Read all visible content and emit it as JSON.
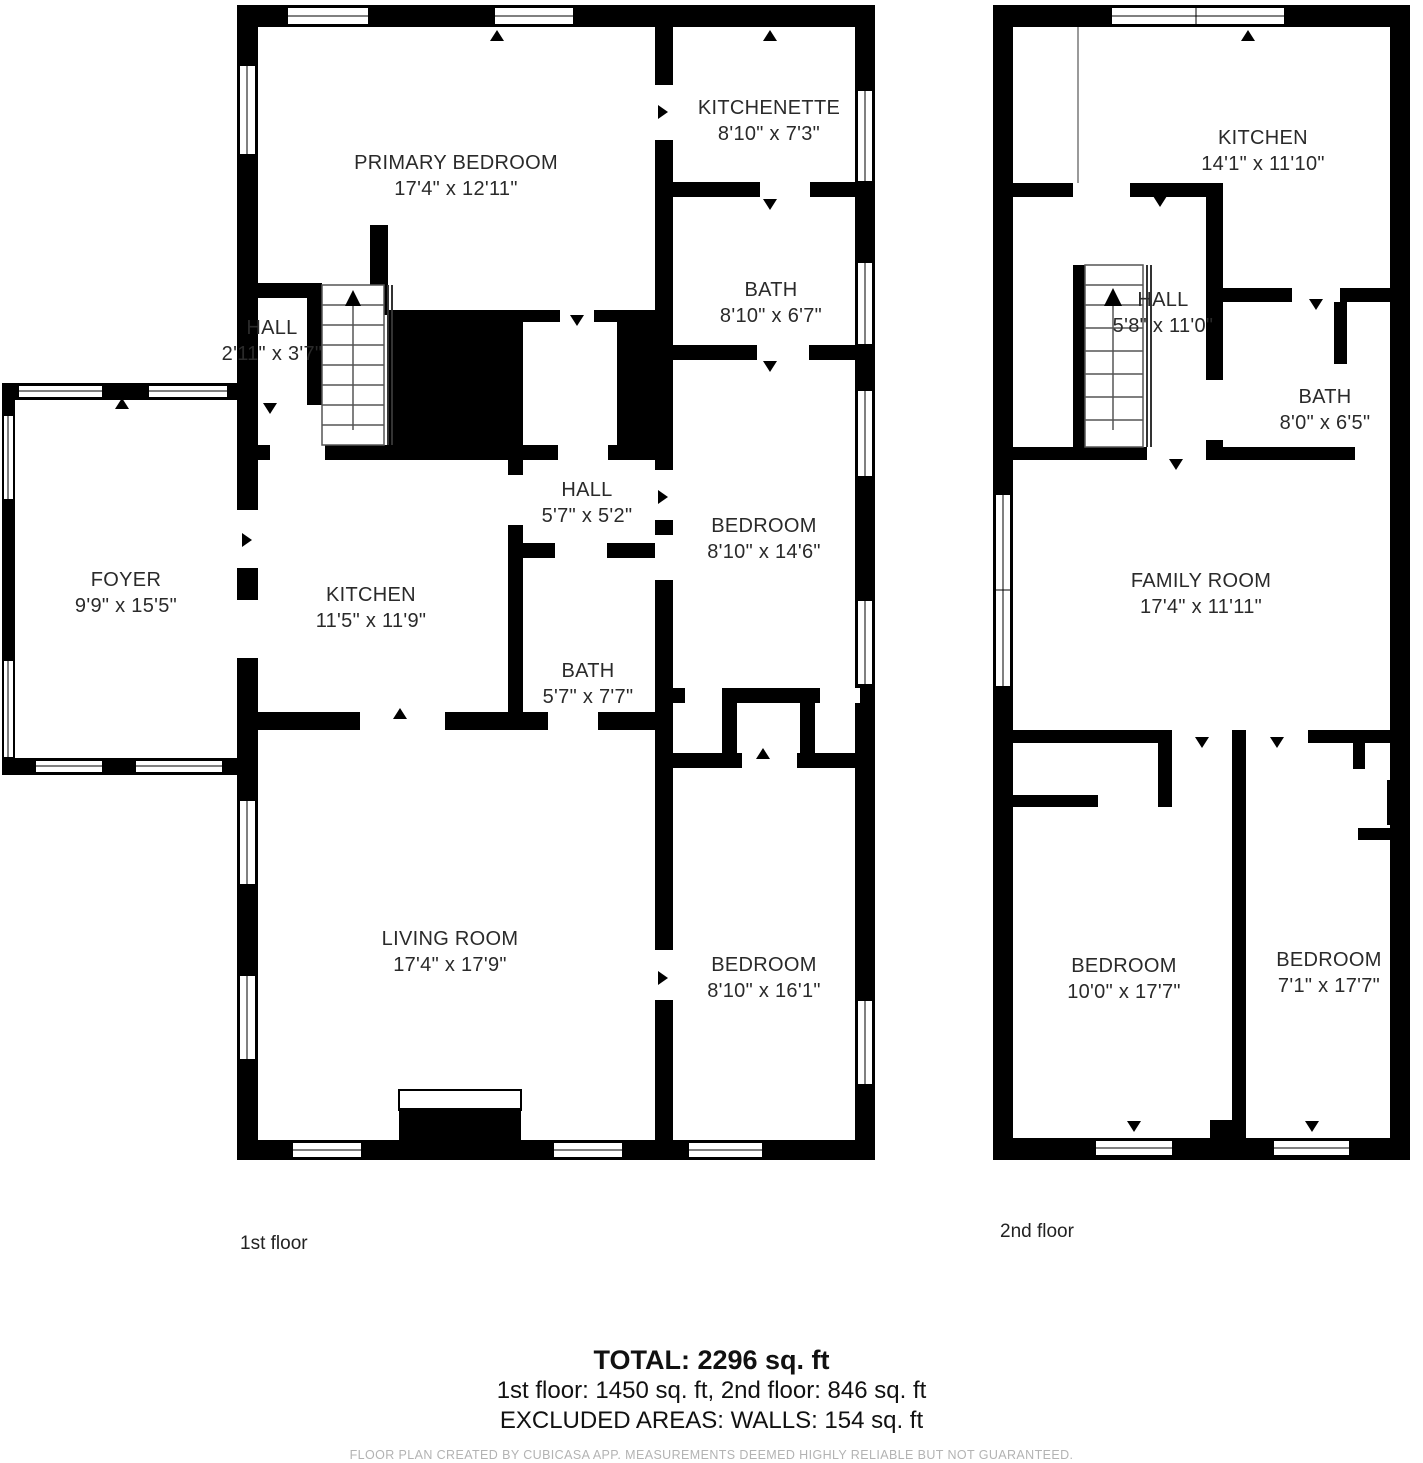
{
  "floors": [
    {
      "caption": "1st floor",
      "rooms": [
        {
          "name": "PRIMARY BEDROOM",
          "dims": "17'4\" x 12'11\""
        },
        {
          "name": "KITCHENETTE",
          "dims": "8'10\" x 7'3\""
        },
        {
          "name": "BATH",
          "dims": "8'10\" x 6'7\""
        },
        {
          "name": "HALL",
          "dims": "2'11\" x 3'7\""
        },
        {
          "name": "BEDROOM",
          "dims": "8'10\" x 14'6\""
        },
        {
          "name": "HALL",
          "dims": "5'7\" x 5'2\""
        },
        {
          "name": "FOYER",
          "dims": "9'9\" x 15'5\""
        },
        {
          "name": "KITCHEN",
          "dims": "11'5\" x 11'9\""
        },
        {
          "name": "BATH",
          "dims": "5'7\" x 7'7\""
        },
        {
          "name": "LIVING ROOM",
          "dims": "17'4\" x 17'9\""
        },
        {
          "name": "BEDROOM",
          "dims": "8'10\" x 16'1\""
        }
      ]
    },
    {
      "caption": "2nd floor",
      "rooms": [
        {
          "name": "KITCHEN",
          "dims": "14'1\" x 11'10\""
        },
        {
          "name": "HALL",
          "dims": "5'8\" x 11'0\""
        },
        {
          "name": "BATH",
          "dims": "8'0\" x 6'5\""
        },
        {
          "name": "FAMILY ROOM",
          "dims": "17'4\" x 11'11\""
        },
        {
          "name": "BEDROOM",
          "dims": "10'0\" x 17'7\""
        },
        {
          "name": "BEDROOM",
          "dims": "7'1\" x 17'7\""
        }
      ]
    }
  ],
  "summary": {
    "total": "TOTAL: 2296 sq. ft",
    "floors_line": "1st floor: 1450 sq. ft, 2nd floor: 846 sq. ft",
    "excluded_line": "EXCLUDED AREAS: WALLS: 154 sq. ft"
  },
  "footer": "FLOOR PLAN CREATED BY CUBICASA APP. MEASUREMENTS DEEMED HIGHLY RELIABLE BUT NOT GUARANTEED.",
  "colors": {
    "wall": "#000000",
    "text": "#2a2a2a",
    "footer_text": "#b3b3b3",
    "background": "#ffffff"
  }
}
